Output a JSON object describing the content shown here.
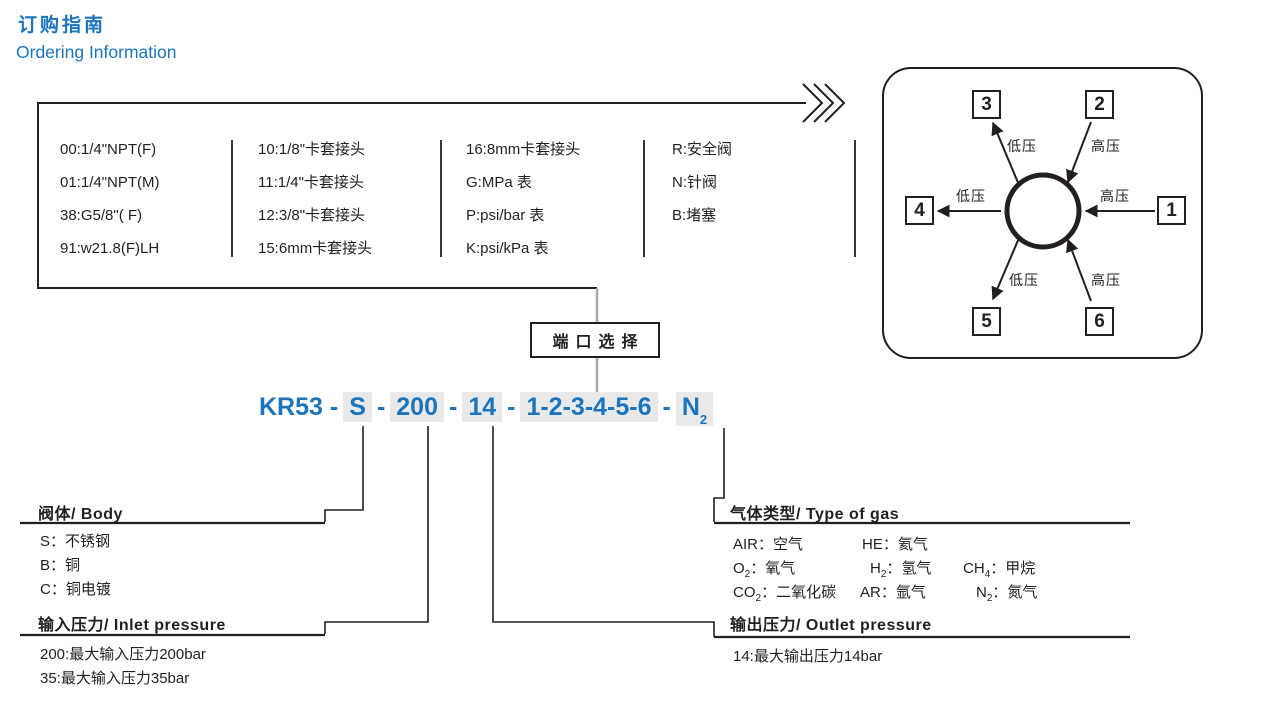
{
  "colors": {
    "accent_blue": "#1B75BC",
    "highlight_gray": "#E9E9E9",
    "line_black": "#231F20",
    "connector_gray": "#A9A9A9"
  },
  "header": {
    "title_cn": "订购指南",
    "title_en": "Ordering Information"
  },
  "options_table": {
    "columns": [
      {
        "items": [
          "00:1/4\"NPT(F)",
          "01:1/4\"NPT(M)",
          "38:G5/8\"( F)",
          "91:w21.8(F)LH"
        ]
      },
      {
        "items": [
          "10:1/8\"卡套接头",
          "11:1/4\"卡套接头",
          "12:3/8\"卡套接头",
          "15:6mm卡套接头"
        ]
      },
      {
        "items": [
          "16:8mm卡套接头",
          "G:MPa 表",
          "P:psi/bar 表",
          "K:psi/kPa 表"
        ]
      },
      {
        "items": [
          "R:安全阀",
          "N:针阀",
          "B:堵塞"
        ]
      }
    ]
  },
  "port_selector": {
    "label": "端口选择"
  },
  "model_code": {
    "prefix": "KR53",
    "dash": "-",
    "body": "S",
    "inlet": "200",
    "outlet": "14",
    "ports": "1-2-3-4-5-6",
    "gas": "N",
    "gas_sub": "2"
  },
  "body_section": {
    "title": "阀体/ Body",
    "items": [
      "S：不锈钢",
      "B：铜",
      "C：铜电镀"
    ]
  },
  "inlet_section": {
    "title": "输入压力/ Inlet pressure",
    "items": [
      "200:最大输入压力200bar",
      "35:最大输入压力35bar"
    ]
  },
  "gas_section": {
    "title": "气体类型/ Type of gas",
    "items": [
      {
        "pre": "AIR",
        "sub": "",
        "post": "：空气"
      },
      {
        "pre": "HE",
        "sub": "",
        "post": "：氦气"
      },
      {
        "pre": "O",
        "sub": "2",
        "post": "：氧气"
      },
      {
        "pre": "H",
        "sub": "2",
        "post": "：氢气"
      },
      {
        "pre": "CH",
        "sub": "4",
        "post": "：甲烷"
      },
      {
        "pre": "CO",
        "sub": "2",
        "post": "：二氧化碳"
      },
      {
        "pre": "AR",
        "sub": "",
        "post": "：氩气"
      },
      {
        "pre": "N",
        "sub": "2",
        "post": "：氮气"
      }
    ]
  },
  "outlet_section": {
    "title": "输出压力/ Outlet pressure",
    "items": [
      "14:最大输出压力14bar"
    ]
  },
  "port_diagram": {
    "ports": [
      {
        "num": "1",
        "pressure": "高压"
      },
      {
        "num": "2",
        "pressure": "高压"
      },
      {
        "num": "3",
        "pressure": "低压"
      },
      {
        "num": "4",
        "pressure": "低压"
      },
      {
        "num": "5",
        "pressure": "低压"
      },
      {
        "num": "6",
        "pressure": "高压"
      }
    ]
  }
}
